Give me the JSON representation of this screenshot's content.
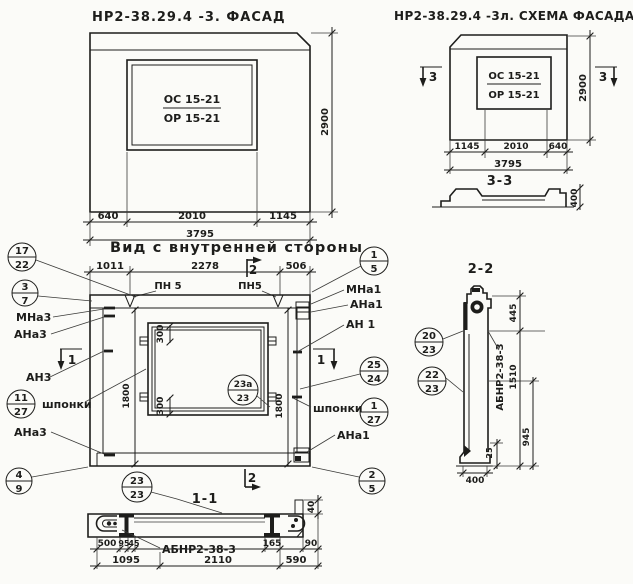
{
  "page": {
    "background": "#fbfbf8",
    "ink": "#1d1d1b"
  },
  "facade": {
    "title": "НР2-38.29.4 -3. ФАСАД",
    "window_mark_top": "ОС 15-21",
    "window_mark_bottom": "ОР 15-21",
    "dim_640": "640",
    "dim_2010": "2010",
    "dim_1145": "1145",
    "dim_3795": "3795",
    "dim_2900": "2900"
  },
  "schema": {
    "title": "НР2-38.29.4 -3л. СХЕМА ФАСАДА",
    "window_mark_top": "ОС 15-21",
    "window_mark_bottom": "ОР 15-21",
    "section_mark_left": "3",
    "section_mark_right": "3",
    "dim_1145": "1145",
    "dim_2010": "2010",
    "dim_640": "640",
    "dim_3795": "3795",
    "dim_2900": "2900",
    "section33_title": "3-3",
    "section33_dim_400": "400"
  },
  "inner": {
    "title": "Вид с внутренней стороны",
    "dim_1011": "1011",
    "dim_2278": "2278",
    "dim_506": "506",
    "rail_left": "ПН 5",
    "rail_right": "ПН5",
    "sec2_top": "2",
    "sec2_bottom": "2",
    "sec1_left": "1",
    "sec1_right": "1",
    "dim_300_top": "300",
    "dim_300_bottom": "300",
    "dim_1800_left": "1800",
    "dim_1800_right": "1800",
    "left": {
      "c17": "17",
      "c22": "22",
      "c3": "3",
      "c7": "7",
      "mna3": "МНа3",
      "ana3": "АНа3",
      "an3": "АН3",
      "c11": "11",
      "c27": "27",
      "shponki": "шпонки",
      "ana3_low": "АНа3",
      "c4": "4",
      "c9": "9"
    },
    "right": {
      "c1": "1",
      "c5": "5",
      "mna1": "МНа1",
      "ana1": "АНа1",
      "an1": "АН 1",
      "c25": "25",
      "c24": "24",
      "shponki": "шпонки",
      "c1b": "1",
      "c27": "27",
      "ana1_low": "АНа1",
      "c2": "2",
      "c5b": "5"
    },
    "c23a_top": "23а",
    "c23a_bottom": "23",
    "c23_top": "23",
    "c23_bottom": "23"
  },
  "sec11": {
    "title": "1-1",
    "label": "АБНР2-38-3",
    "dim_500": "500",
    "dim_95": "95",
    "dim_45": "45",
    "dim_165": "165",
    "dim_90": "90",
    "dim_40": "40",
    "dim_1095": "1095",
    "dim_2110": "2110",
    "dim_590": "590"
  },
  "sec22": {
    "title": "2-2",
    "label": "АБНР2-38-3",
    "c20": "20",
    "c23a": "23",
    "c22": "22",
    "c23b": "23",
    "dim_445": "445",
    "dim_1510": "1510",
    "dim_945": "945",
    "dim_25": "25",
    "dim_400": "400"
  }
}
